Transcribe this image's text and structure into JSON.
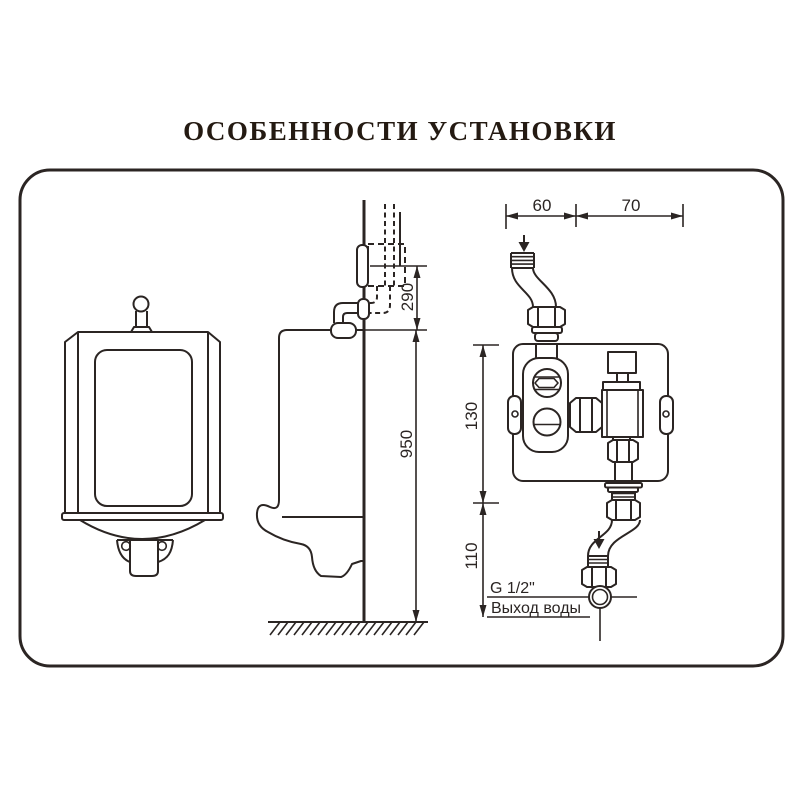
{
  "title": "ОСОБЕННОСТИ УСТАНОВКИ",
  "colors": {
    "line": "#2b2523",
    "title": "#241a12",
    "frame": "#1d1713",
    "background": "#ffffff"
  },
  "side_view": {
    "dim_pipe_center": "290",
    "dim_rim_height": "950"
  },
  "valve_unit": {
    "dim_inlet_offset": "60",
    "dim_valve_offset": "70",
    "dim_body_section": "130",
    "dim_outlet_section": "110",
    "outlet_thread_label": "G 1/2\"",
    "outlet_caption": "Выход воды"
  }
}
